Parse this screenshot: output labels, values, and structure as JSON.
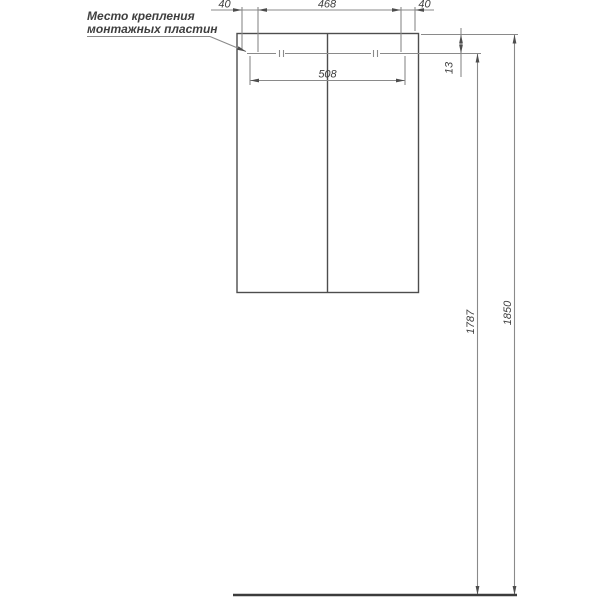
{
  "colors": {
    "background": "#ffffff",
    "object_line": "#4d4d4d",
    "thin_line": "#8a8a8a",
    "floor_line": "#3c3c3c",
    "text": "#3f3f3f"
  },
  "note": {
    "line1": "Место крепления",
    "line2": "монтажных пластин"
  },
  "dimensions": {
    "top_left": "40",
    "top_center": "468",
    "top_right": "40",
    "plate_span": "508",
    "rail_offset": "13",
    "mount_height": "1787",
    "total_height": "1850"
  }
}
